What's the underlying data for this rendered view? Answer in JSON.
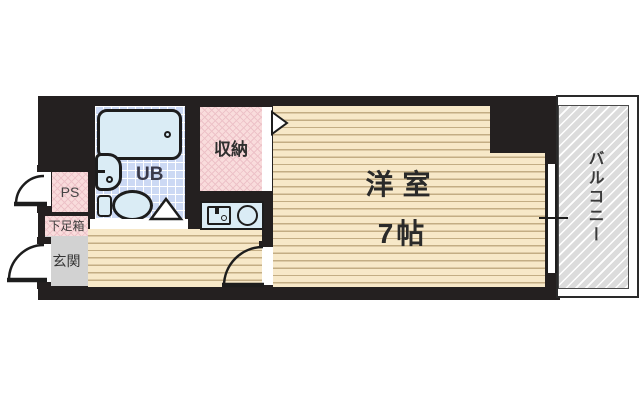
{
  "plan": {
    "rooms": {
      "main_room": {
        "name_line": "洋室",
        "size_line": "7帖"
      },
      "balcony": {
        "label": "バルコニー"
      },
      "unit_bath": {
        "label": "UB"
      },
      "closet": {
        "label": "収納"
      },
      "pipe_space": {
        "label": "PS"
      },
      "shoe_box": {
        "label": "下足箱"
      },
      "entrance": {
        "label": "玄関"
      }
    },
    "fixtures": {
      "bath": [
        "bathtub",
        "washbasin",
        "toilet"
      ],
      "kitchen": [
        "kitchen-sink",
        "stove-burner"
      ]
    },
    "colors": {
      "wall": "#242020",
      "wood_floor": "#f7e8c8",
      "wood_line": "#c3ad84",
      "pink_area": "#f9dcdc",
      "bath_tile": "#ccd9f4",
      "fixture_fill": "#daecf5",
      "entrance_gray": "#d2d2d2",
      "balcony_gray": "#dcdcdc",
      "line": "#1d1d1d"
    }
  }
}
